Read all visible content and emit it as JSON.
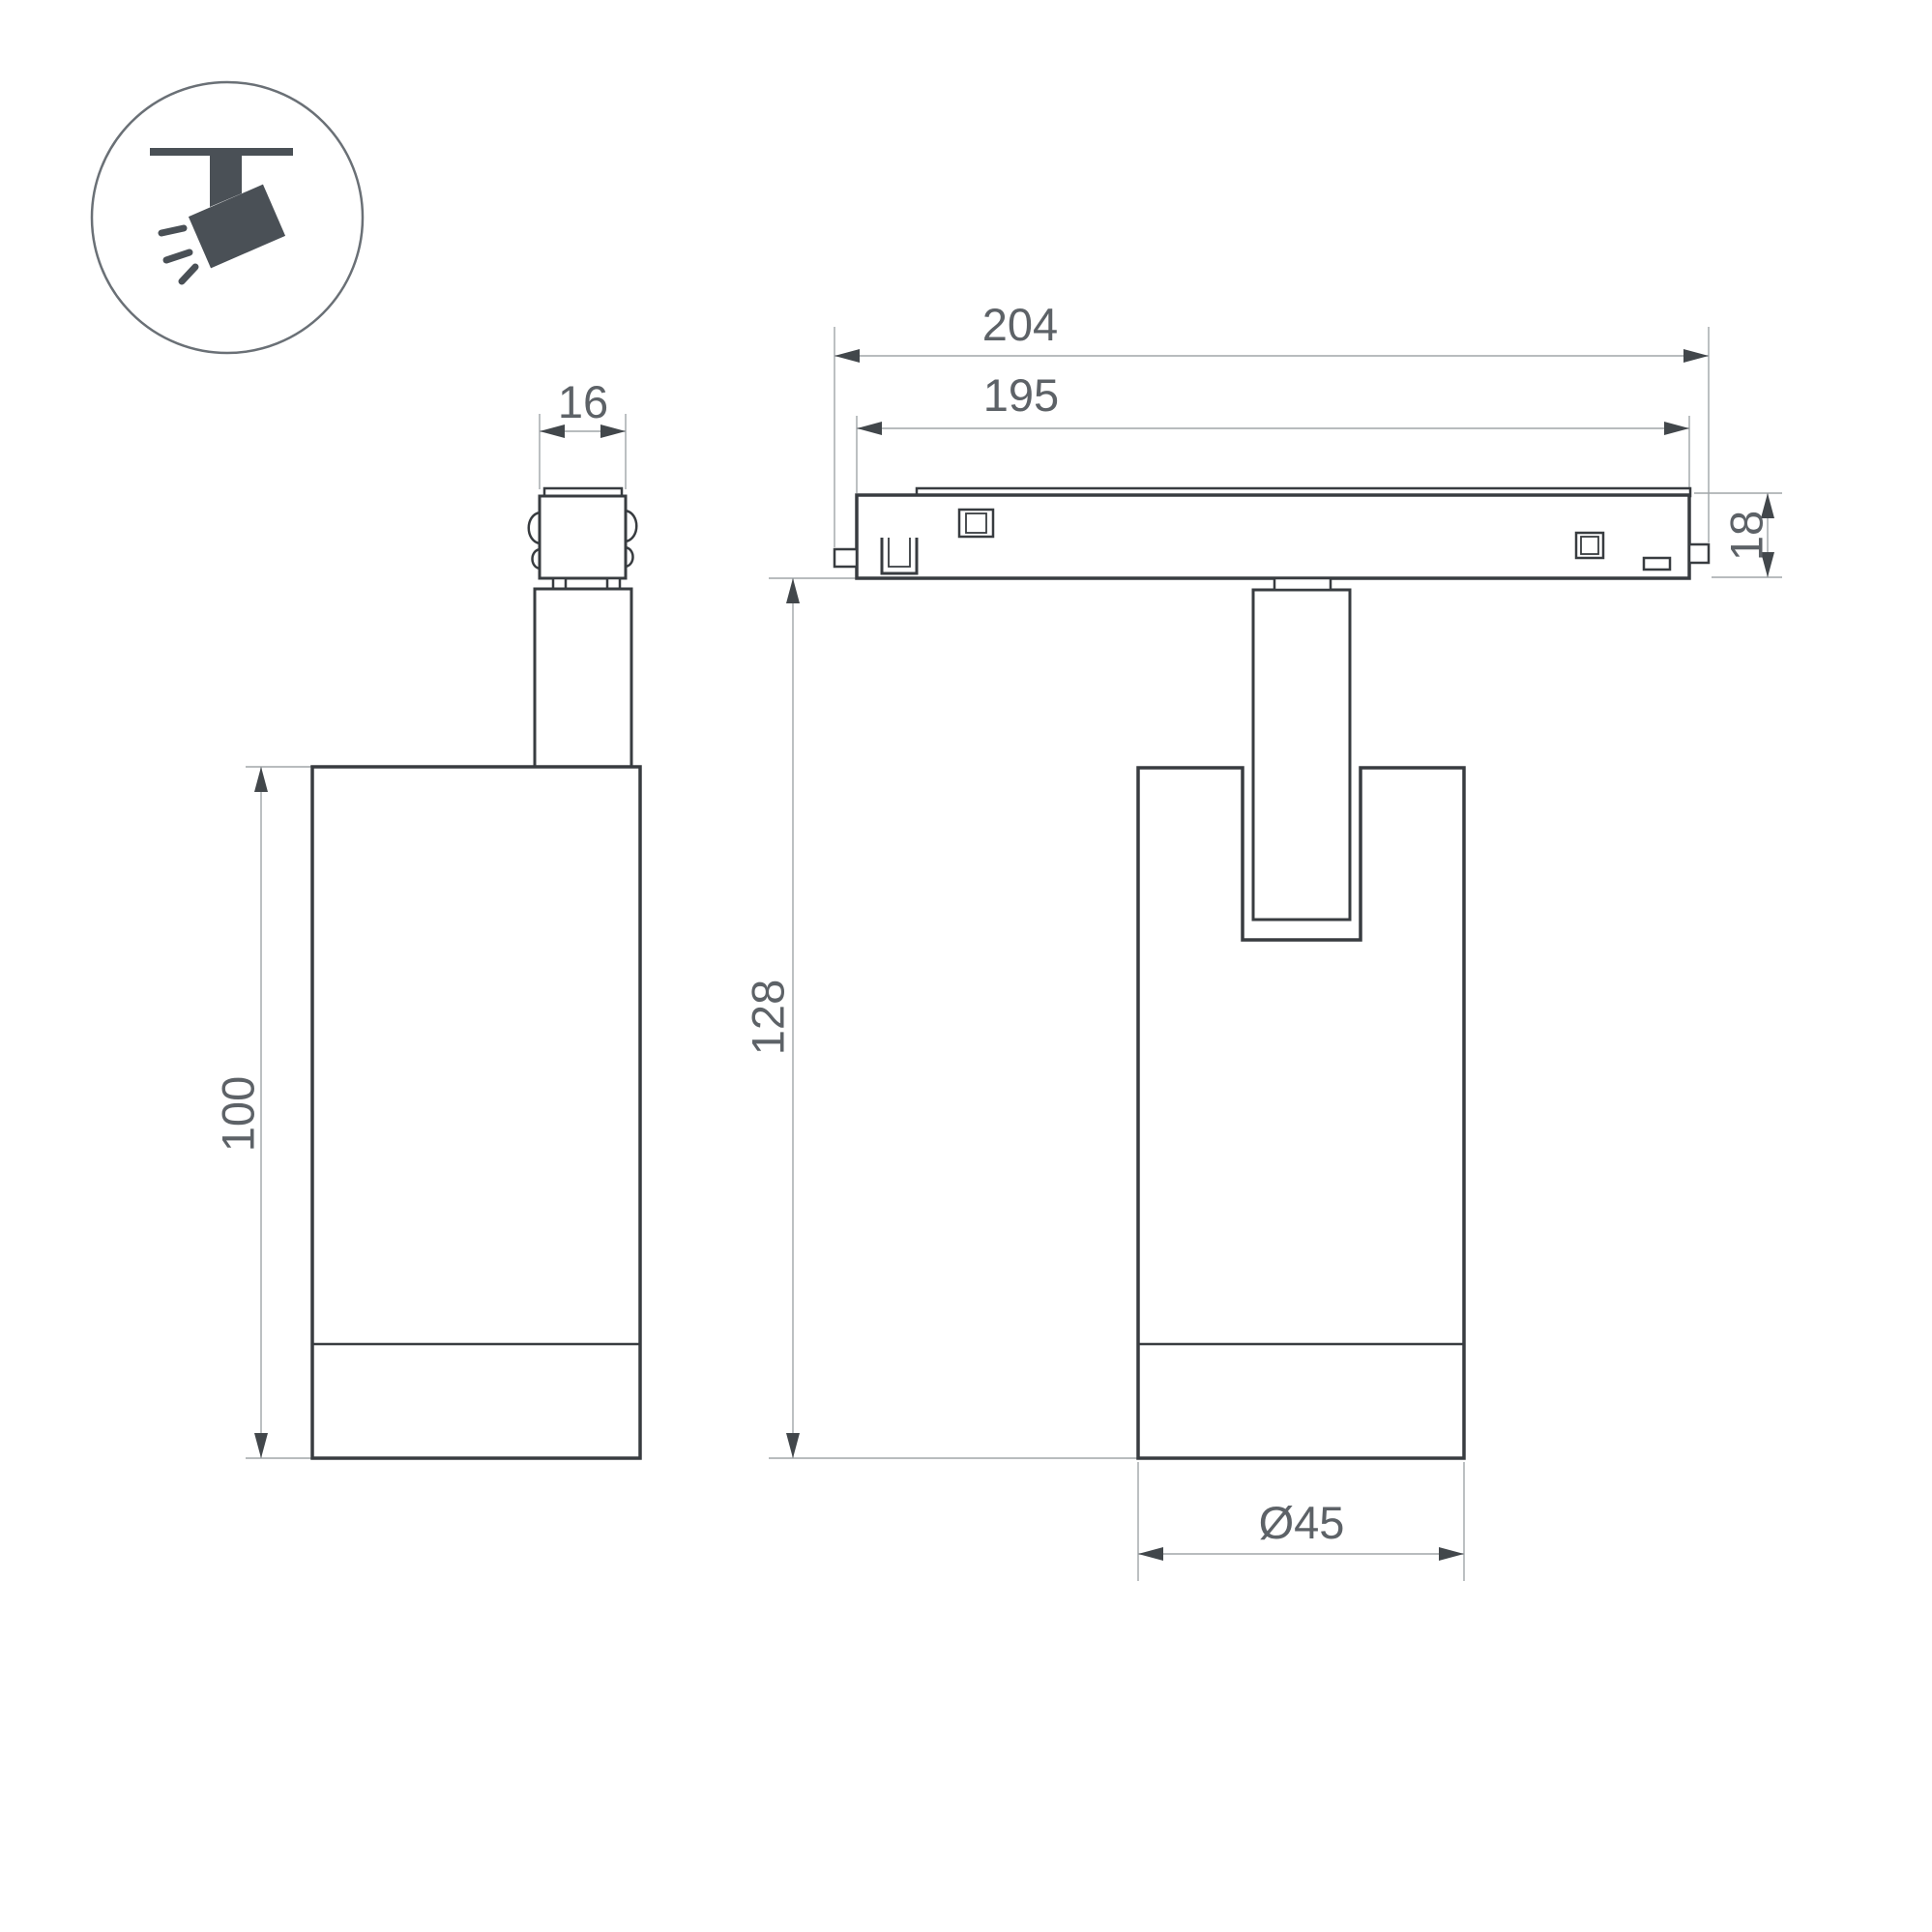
{
  "page": {
    "background": "#ffffff"
  },
  "colors": {
    "outline": "#383c40",
    "dimension_lines": "#a0a5a8",
    "dimension_text": "#5d6267",
    "arrowheads": "#42474b",
    "icon_fill": "#4a5056",
    "icon_circle": "#6a7076"
  },
  "icon": {
    "name": "ceiling-track-spotlight-icon"
  },
  "views": {
    "side": {
      "dimensions": {
        "connector_width": "16",
        "body_height": "100"
      }
    },
    "front": {
      "dimensions": {
        "track_overall_length": "204",
        "track_body_length": "195",
        "track_height": "18",
        "overall_height": "128",
        "body_diameter": "Ø45"
      }
    }
  }
}
